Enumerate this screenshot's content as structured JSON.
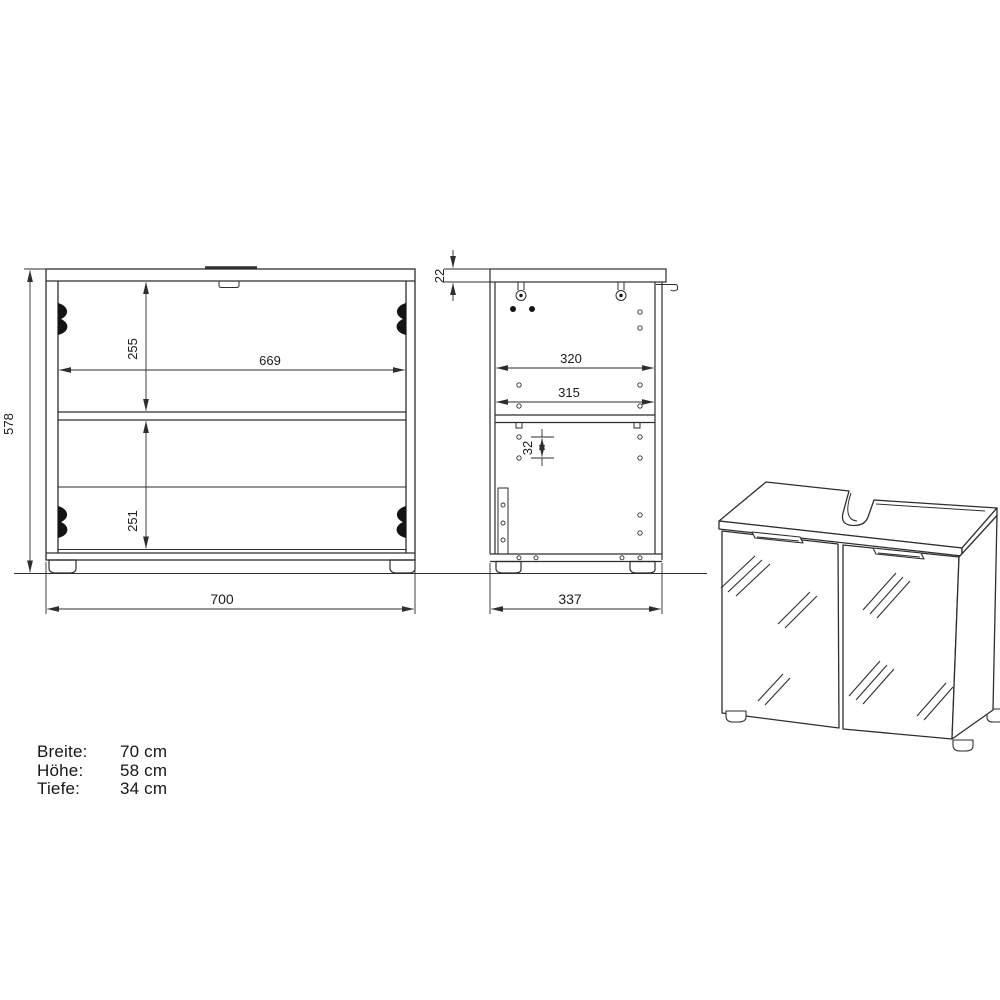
{
  "drawing": {
    "background_color": "#ffffff",
    "line_color": "#2e2e2e",
    "text_color": "#1b1b1b"
  },
  "front_view": {
    "overall_width": "700",
    "overall_height": "578",
    "inner_width": "669",
    "upper_compartment_height": "255",
    "lower_compartment_height": "251"
  },
  "side_view": {
    "overall_depth": "337",
    "top_panel_thickness": "22",
    "inner_depth_upper": "320",
    "inner_depth_lower": "315",
    "hole_pitch": "32"
  },
  "specs": {
    "rows": [
      {
        "label": "Breite:",
        "value": "70 cm"
      },
      {
        "label": "Höhe:",
        "value": "58 cm"
      },
      {
        "label": "Tiefe:",
        "value": "34 cm"
      }
    ]
  }
}
